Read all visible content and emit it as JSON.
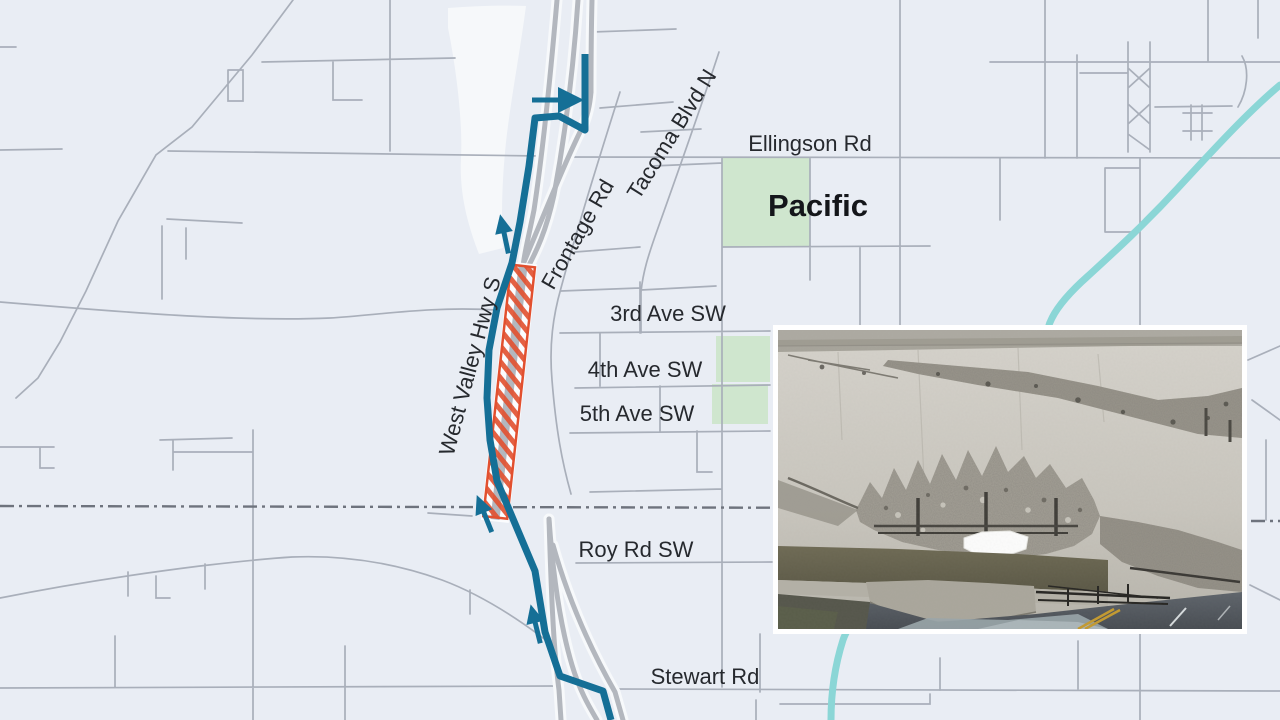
{
  "map": {
    "city_label": "Pacific",
    "road_labels": {
      "ellingson": "Ellingson Rd",
      "third_ave": "3rd Ave SW",
      "fourth_ave": "4th Ave SW",
      "fifth_ave": "5th Ave SW",
      "roy_rd": "Roy Rd SW",
      "stewart_rd": "Stewart Rd",
      "frontage_rd": "Frontage Rd",
      "tacoma_blvd": "Tacoma Blvd N",
      "west_valley_hwy": "West Valley Hwy S"
    },
    "features": {
      "background_color": "#e9edf4",
      "street_color": "#a9afba",
      "highway_color": "#b3b7be",
      "detour_route_color": "#156f96",
      "closure_hatch_color": "#e2502f",
      "river_color": "#8bd6d6",
      "park_color": "#cfe6ce",
      "boundary_color": "#6e737d",
      "label_color": "#26292e"
    }
  },
  "inset": {
    "photo_name": "bridge-damage-photo"
  }
}
